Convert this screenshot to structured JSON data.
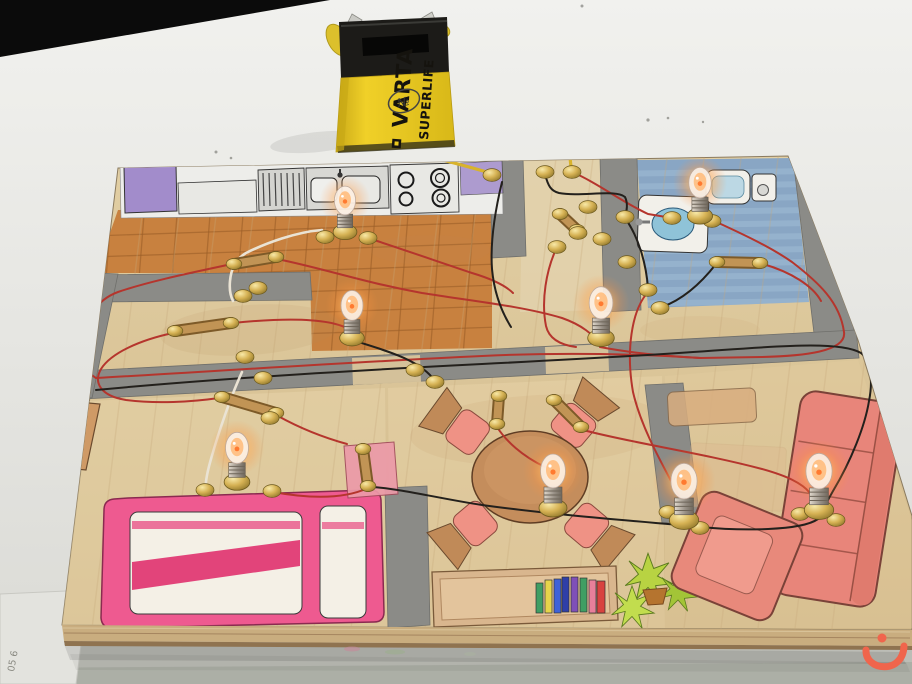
{
  "scene": {
    "kind": "photograph",
    "subject": "School physics project: model house floor-plan wiring board with battery-powered light bulbs",
    "table_color": "#e9e9e5",
    "backdrop_color": "#0b0b0b",
    "foreground_color": "#bcbdb6"
  },
  "battery": {
    "brand": "VARTA",
    "line": "SUPERLIFE",
    "handwritten_mark": "№",
    "body_color": "#e9c71f",
    "cap_color": "#1b1a18",
    "wire_color": "#d8b32c"
  },
  "watermark": {
    "glyph": "ن",
    "color": "#f0654c"
  },
  "paper_label": {
    "text": "05 6"
  },
  "board": {
    "wood_color": "#dcc79c",
    "rooms": [
      "kitchen",
      "entry",
      "bathroom",
      "hallway",
      "bedroom",
      "dining-room",
      "living-room"
    ],
    "bulbs": [
      {
        "room": "kitchen",
        "x": 345,
        "y": 232,
        "s": 0.85,
        "glow": 0.75
      },
      {
        "room": "bathroom",
        "x": 700,
        "y": 216,
        "s": 0.9,
        "glow": 0.95
      },
      {
        "room": "hallway-left",
        "x": 352,
        "y": 338,
        "s": 0.88,
        "glow": 0.8
      },
      {
        "room": "hallway-center",
        "x": 601,
        "y": 338,
        "s": 0.95,
        "glow": 0.85
      },
      {
        "room": "bedroom",
        "x": 237,
        "y": 482,
        "s": 0.92,
        "glow": 0.85
      },
      {
        "room": "dining-room",
        "x": 553,
        "y": 508,
        "s": 1.0,
        "glow": 0.9
      },
      {
        "room": "living-room-left",
        "x": 684,
        "y": 520,
        "s": 1.05,
        "glow": 1.0
      },
      {
        "room": "living-room-right",
        "x": 819,
        "y": 510,
        "s": 1.05,
        "glow": 1.0
      }
    ],
    "fasteners": [
      [
        492,
        175
      ],
      [
        545,
        172
      ],
      [
        572,
        172
      ],
      [
        588,
        207
      ],
      [
        578,
        233
      ],
      [
        602,
        239
      ],
      [
        557,
        247
      ],
      [
        625,
        217
      ],
      [
        627,
        262
      ],
      [
        648,
        290
      ],
      [
        660,
        308
      ],
      [
        672,
        218
      ],
      [
        712,
        221
      ],
      [
        325,
        237
      ],
      [
        368,
        238
      ],
      [
        258,
        288
      ],
      [
        243,
        296
      ],
      [
        245,
        357
      ],
      [
        263,
        378
      ],
      [
        270,
        418
      ],
      [
        415,
        370
      ],
      [
        435,
        382
      ],
      [
        205,
        490
      ],
      [
        272,
        491
      ],
      [
        668,
        512
      ],
      [
        700,
        528
      ],
      [
        800,
        514
      ],
      [
        836,
        520
      ]
    ],
    "switches": [
      {
        "x1": 234,
        "y1": 264,
        "x2": 276,
        "y2": 257
      },
      {
        "x1": 175,
        "y1": 331,
        "x2": 231,
        "y2": 323
      },
      {
        "x1": 222,
        "y1": 397,
        "x2": 276,
        "y2": 413
      },
      {
        "x1": 560,
        "y1": 214,
        "x2": 577,
        "y2": 230
      },
      {
        "x1": 717,
        "y1": 262,
        "x2": 760,
        "y2": 263
      },
      {
        "x1": 499,
        "y1": 396,
        "x2": 497,
        "y2": 424
      },
      {
        "x1": 554,
        "y1": 400,
        "x2": 581,
        "y2": 427
      },
      {
        "x1": 363,
        "y1": 449,
        "x2": 368,
        "y2": 486
      }
    ],
    "wires": [
      {
        "name": "yellow-left",
        "color": "#d8b32c",
        "w": 3.2,
        "d": "M340,52 C318,74 314,98 330,118 C352,142 420,152 490,173"
      },
      {
        "name": "yellow-right",
        "color": "#d8b32c",
        "w": 3.2,
        "d": "M438,30 C500,8 580,18 620,48 C648,70 610,100 585,125 C570,140 568,156 572,170"
      },
      {
        "name": "red-1",
        "color": "#b5352d",
        "w": 2,
        "d": "M572,172 C596,182 622,202 648,214 L672,218"
      },
      {
        "name": "red-2",
        "color": "#b5352d",
        "w": 2,
        "d": "M712,220 C745,235 772,248 792,262 C818,282 840,302 844,332 C847,352 802,356 762,357 L700,358"
      },
      {
        "name": "red-3",
        "color": "#b5352d",
        "w": 2,
        "d": "M277,259 C322,268 362,282 422,293 C472,301 522,306 562,318 C582,325 594,335 599,344"
      },
      {
        "name": "red-4",
        "color": "#b5352d",
        "w": 2,
        "d": "M232,264 C195,272 150,281 118,292 C96,300 83,321 81,346 C80,361 86,372 96,378"
      },
      {
        "name": "red-5",
        "color": "#b5352d",
        "w": 2,
        "d": "M173,333 C140,340 111,353 101,369 C93,383 101,396 126,400 C156,404 191,402 219,398"
      },
      {
        "name": "red-6",
        "color": "#b5352d",
        "w": 2,
        "d": "M278,416 C296,426 318,436 347,444"
      },
      {
        "name": "red-7",
        "color": "#b5352d",
        "w": 2,
        "d": "M368,488 C342,500 306,498 273,492"
      },
      {
        "name": "red-8",
        "color": "#b5352d",
        "w": 2,
        "d": "M497,427 C506,441 522,456 545,467"
      },
      {
        "name": "red-9",
        "color": "#b5352d",
        "w": 2,
        "d": "M583,430 C632,443 702,453 762,469 C787,476 802,483 810,493"
      },
      {
        "name": "red-10",
        "color": "#b5352d",
        "w": 2,
        "d": "M648,292 C631,311 626,352 633,392 C641,427 661,462 677,492 C681,500 683,506 684,513"
      },
      {
        "name": "red-11",
        "color": "#b5352d",
        "w": 2,
        "d": "M600,347 C626,352 662,356 701,358"
      },
      {
        "name": "red-12",
        "color": "#b5352d",
        "w": 2,
        "d": "M96,378 C202,372 352,362 482,356 C562,352 642,354 700,358"
      },
      {
        "name": "red-13",
        "color": "#b5352d",
        "w": 2,
        "d": "M368,238 C402,249 442,263 472,273 C492,279 506,286 513,293"
      },
      {
        "name": "red-14",
        "color": "#b5352d",
        "w": 2,
        "d": "M233,323 C282,318 332,317 352,331"
      },
      {
        "name": "red-15",
        "color": "#b5352d",
        "w": 2,
        "d": "M557,247 C546,270 541,301 546,326 C549,339 561,345 576,347"
      },
      {
        "name": "red-16",
        "color": "#b5352d",
        "w": 2,
        "d": "M763,264 C791,272 813,286 821,301"
      },
      {
        "name": "black-1",
        "color": "#23201c",
        "w": 2,
        "d": "M545,174 C548,186 551,191 559,193 C581,197 616,189 625,197 C628,203 627,211 625,216"
      },
      {
        "name": "black-2",
        "color": "#23201c",
        "w": 2,
        "d": "M625,218 C638,236 646,262 648,288"
      },
      {
        "name": "black-3",
        "color": "#23201c",
        "w": 2,
        "d": "M716,264 C702,282 684,299 662,307"
      },
      {
        "name": "black-4",
        "color": "#23201c",
        "w": 2,
        "d": "M96,390 C222,378 362,370 482,364 C562,360 642,356 722,350 C792,345 842,342 861,353 C871,361 873,381 869,401 C865,426 851,461 833,491 C825,505 821,513 818,519 C801,531 741,531 701,527 C661,523 561,516 482,505 C442,499 402,489 373,487"
      },
      {
        "name": "black-5",
        "color": "#23201c",
        "w": 2,
        "d": "M100,290 C83,321 75,356 81,388"
      },
      {
        "name": "black-6",
        "color": "#23201c",
        "w": 2,
        "d": "M502,182 C495,211 490,241 492,269 C494,291 501,311 511,327"
      },
      {
        "name": "black-7",
        "color": "#23201c",
        "w": 2,
        "d": "M355,341 C391,352 421,361 435,381"
      },
      {
        "name": "white-1",
        "color": "#eae3d4",
        "w": 2.6,
        "d": "M322,230 C296,232 266,243 246,253 C236,259 231,269 230,281 C229,291 231,297 233,301"
      },
      {
        "name": "white-2",
        "color": "#eae3d4",
        "w": 2.6,
        "d": "M242,372 C231,396 219,431 211,459 C207,473 205,483 206,489"
      }
    ]
  }
}
